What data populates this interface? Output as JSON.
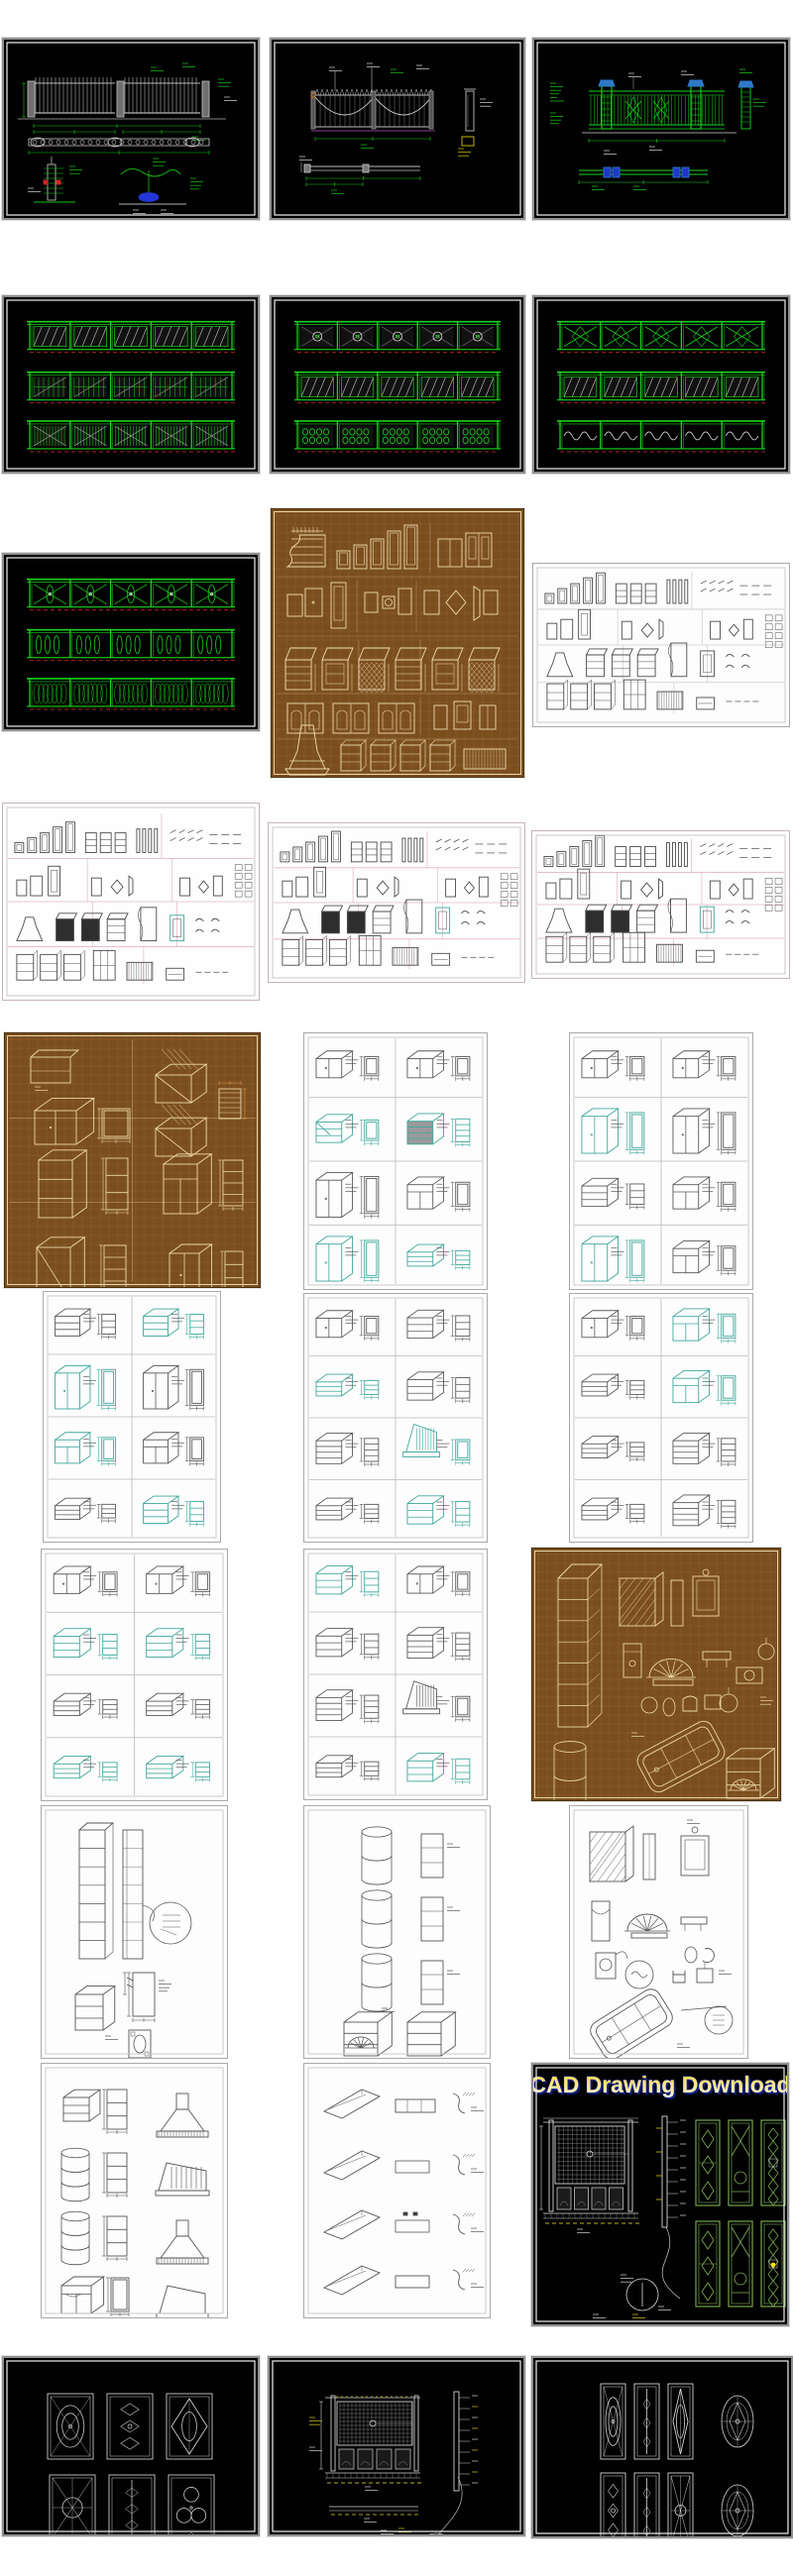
{
  "page": {
    "background": "#ffffff",
    "kind": "cad-drawing-preview-collage"
  },
  "banner": {
    "text": "CAD Drawing Download",
    "fill_top": "#ffd636",
    "fill_bottom": "#f8f3df",
    "outline": "#2636c8",
    "shadow": "#101c6e"
  },
  "palette": {
    "cad_green": "#1ec81e",
    "cad_dark_green": "#0a8f0a",
    "cad_grey": "#b6b6b6",
    "cad_white": "#e8e8e8",
    "cad_red": "#c02020",
    "cad_blue": "#2e56d8",
    "cad_yellow": "#cfc22a",
    "brown_bg": "#7b4e1e",
    "cream_line": "#ecd9a8",
    "sheet_ink": "#4b4b4b",
    "pink_grid": "#e2b6c8",
    "teal": "#3fa89b",
    "lattice_green": "#7fb254"
  },
  "panels": [
    {
      "id": "p01",
      "kind": "fence1",
      "frame": "white",
      "label": "iron-fence-gate-detail-sheet"
    },
    {
      "id": "p02",
      "kind": "fence2",
      "frame": "white",
      "label": "fence-swag-mesh-detail-sheet"
    },
    {
      "id": "p03",
      "kind": "fence3",
      "frame": "white",
      "label": "green-fence-elevation-sheet"
    },
    {
      "id": "p04",
      "kind": "railings",
      "frame": "white",
      "strips": [
        "hatch",
        "grid",
        "bal"
      ],
      "label": "railing-designs-sheet-1"
    },
    {
      "id": "p05",
      "kind": "railings",
      "frame": "white",
      "strips": [
        "rosette",
        "hatch",
        "ornate"
      ],
      "label": "railing-designs-sheet-2"
    },
    {
      "id": "p06",
      "kind": "railings",
      "frame": "white",
      "strips": [
        "lattice",
        "hatch",
        "scroll"
      ],
      "label": "railing-designs-sheet-3"
    },
    {
      "id": "p07",
      "kind": "railings",
      "frame": "white",
      "strips": [
        "xloop",
        "ovals",
        "arcade"
      ],
      "label": "railing-designs-sheet-4"
    },
    {
      "id": "p08",
      "kind": "brownDoors",
      "frame": "cream",
      "label": "cabinet-door-library-brown"
    },
    {
      "id": "p09",
      "kind": "sheet",
      "frame": "grey",
      "grid": "#cccccc",
      "label": "cabinet-door-library-grey"
    },
    {
      "id": "p10",
      "kind": "sheet",
      "frame": "grey",
      "grid": "#e2b6c8",
      "label": "cabinet-door-library-pink-1"
    },
    {
      "id": "p11",
      "kind": "sheet",
      "frame": "grey",
      "grid": "#e2b6c8",
      "label": "cabinet-door-library-pink-2"
    },
    {
      "id": "p12",
      "kind": "sheet",
      "frame": "grey",
      "grid": "#e2b6c8",
      "label": "cabinet-door-library-pink-3"
    },
    {
      "id": "p13",
      "kind": "isoBrown",
      "frame": "cream",
      "label": "isometric-cabinets-brown"
    },
    {
      "id": "p14",
      "kind": "isoWhite",
      "frame": "grey",
      "styles": [
        "w",
        "w",
        "c",
        "d",
        "t",
        "b",
        "t",
        "o"
      ],
      "teal": [
        2,
        3,
        6,
        7
      ],
      "dark": [
        3
      ],
      "label": "isometric-cabinets-grid-1"
    },
    {
      "id": "p15",
      "kind": "isoWhite",
      "frame": "grey",
      "styles": [
        "w",
        "w",
        "t",
        "t",
        "s",
        "b",
        "t",
        "b"
      ],
      "teal": [
        2,
        6
      ],
      "dark": [],
      "label": "isometric-cabinets-grid-2"
    },
    {
      "id": "p16",
      "kind": "isoWhite",
      "frame": "grey",
      "styles": [
        "s",
        "s",
        "t",
        "t",
        "b",
        "b",
        "o",
        "s"
      ],
      "teal": [
        1,
        2,
        4,
        7
      ],
      "dark": [],
      "label": "isometric-cabinets-grid-3"
    },
    {
      "id": "p17",
      "kind": "isoWhite",
      "frame": "grey",
      "styles": [
        "w",
        "s",
        "o",
        "s",
        "d",
        "h",
        "o",
        "s"
      ],
      "teal": [
        2,
        5,
        7
      ],
      "dark": [],
      "label": "isometric-cabinets-grid-4"
    },
    {
      "id": "p18",
      "kind": "isoWhite",
      "frame": "grey",
      "styles": [
        "w",
        "b",
        "o",
        "b",
        "o",
        "d",
        "o",
        "d"
      ],
      "teal": [
        1,
        3
      ],
      "dark": [],
      "label": "isometric-cabinets-grid-5"
    },
    {
      "id": "p19",
      "kind": "isoWhite",
      "frame": "grey",
      "styles": [
        "w",
        "w",
        "s",
        "s",
        "o",
        "o",
        "o",
        "o"
      ],
      "teal": [
        2,
        3,
        6,
        7
      ],
      "dark": [],
      "label": "isometric-cabinets-grid-6"
    },
    {
      "id": "p20",
      "kind": "isoWhite",
      "frame": "grey",
      "styles": [
        "s",
        "w",
        "s",
        "d",
        "d",
        "h",
        "o",
        "s"
      ],
      "teal": [
        0,
        7
      ],
      "dark": [],
      "label": "isometric-cabinets-grid-7"
    },
    {
      "id": "p21",
      "kind": "brownMisc",
      "frame": "cream",
      "label": "kitchen-bath-fixtures-brown"
    },
    {
      "id": "p22",
      "kind": "shelfTall",
      "frame": "grey",
      "label": "tall-shelving-detail-sheet"
    },
    {
      "id": "p23",
      "kind": "cornerShelves",
      "frame": "grey",
      "label": "corner-shelf-units-sheet"
    },
    {
      "id": "p24",
      "kind": "whiteMisc",
      "frame": "grey",
      "label": "kitchen-bath-fixtures-white"
    },
    {
      "id": "p25",
      "kind": "cornerHoods",
      "frame": "grey",
      "label": "corner-cabinets-range-hoods"
    },
    {
      "id": "p26",
      "kind": "sofaProfiles",
      "frame": "grey",
      "label": "molding-profile-sheet"
    },
    {
      "id": "p27",
      "kind": "cadDownload",
      "frame": "white",
      "label": "cad-drawing-download-cover"
    },
    {
      "id": "p28",
      "kind": "decorSix",
      "frame": "white",
      "label": "decorative-glass-panels-1"
    },
    {
      "id": "p29",
      "kind": "latticeDetail",
      "frame": "white",
      "label": "lattice-screen-detail-sheet"
    },
    {
      "id": "p30",
      "kind": "decorOvals",
      "frame": "white",
      "label": "decorative-glass-panels-2"
    }
  ]
}
